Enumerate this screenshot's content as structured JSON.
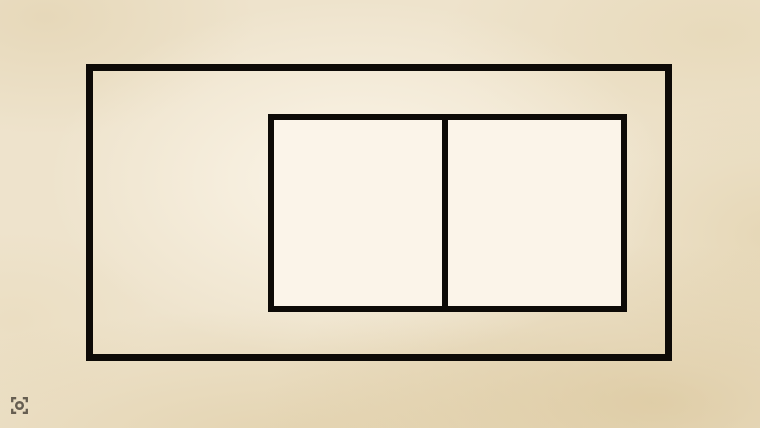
{
  "scene": {
    "description": "Drawing of one large rectangle containing a smaller rectangle divided into two squares by a vertical line, on a parchment background",
    "colors": {
      "background_parchment": "#eee3cc",
      "background_light_center": "#fcf6ea",
      "background_dark_edge": "#ddc9a0",
      "shape_stroke": "#0d0a07",
      "inner_fill": "#fbf4e9",
      "icon_color": "#4a4339"
    },
    "shapes": {
      "outer_rectangle": {
        "x": 86,
        "y": 64,
        "width": 586,
        "height": 297,
        "stroke_width": 7,
        "fill": "none"
      },
      "inner_rectangle": {
        "x": 268,
        "y": 114,
        "width": 359,
        "height": 198,
        "stroke_width": 6,
        "fill": "#fbf4e9"
      },
      "divider_line": {
        "x": 442,
        "y": 116,
        "width": 6,
        "height": 194,
        "fill": "#0d0a07"
      }
    }
  },
  "corner_icon": {
    "name": "screen-capture-focus-icon",
    "x": 10,
    "y": 396,
    "size": 19,
    "color": "#4a4339"
  }
}
